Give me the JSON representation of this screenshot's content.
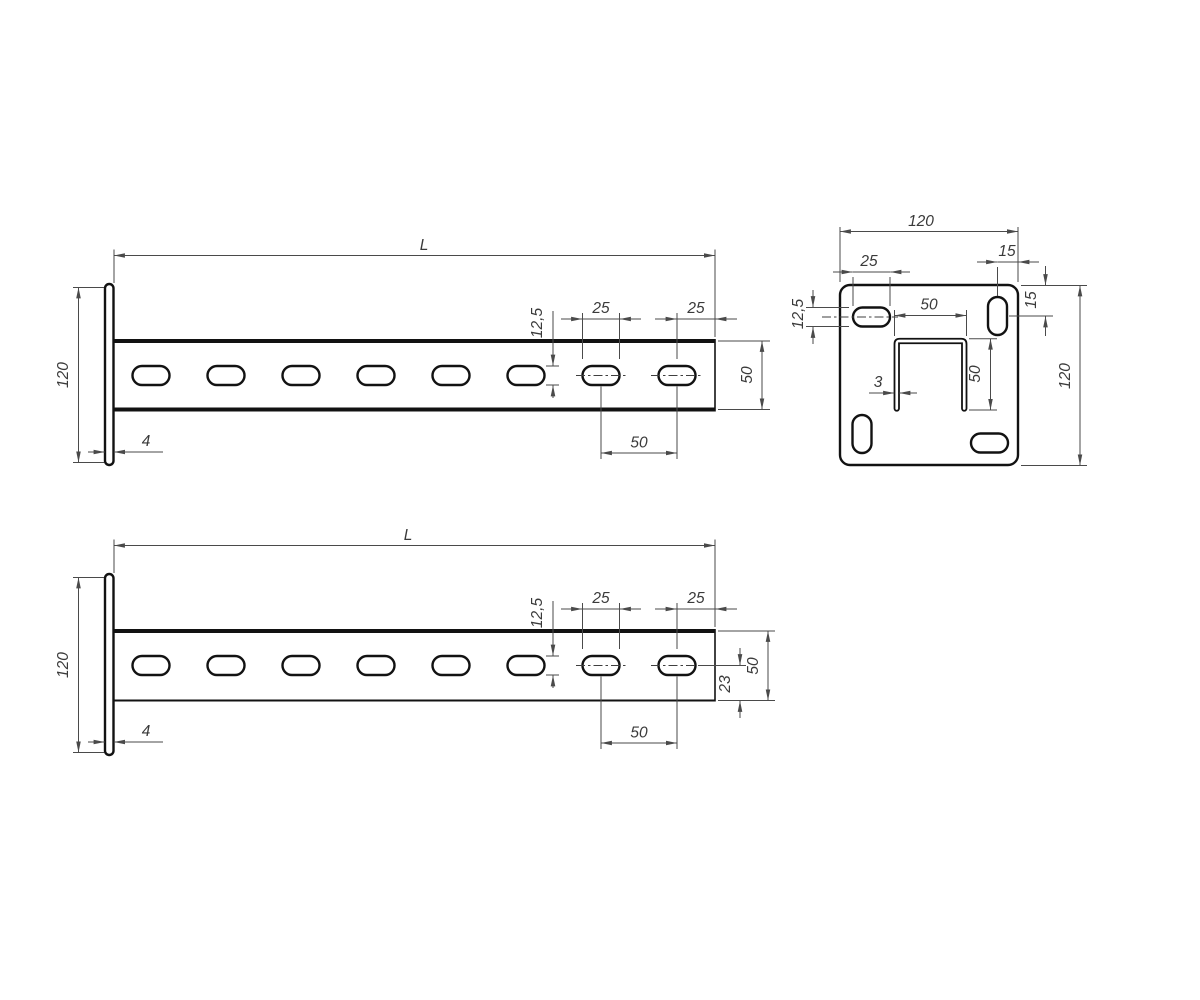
{
  "drawing": {
    "background_color": "#ffffff",
    "object_line_color": "#121212",
    "dimension_line_color": "#4a4a4a",
    "views": {
      "side_a": {
        "length": "L",
        "flange_height": "120",
        "flange_thickness": "4",
        "slot_height": "12,5",
        "slot_length": "25",
        "end_distance": "25",
        "profile_height": "50",
        "slot_pitch": "50"
      },
      "back_plate": {
        "width": "120",
        "height": "120",
        "slot_length": "25",
        "slot_height": "12,5",
        "corner_slot_edge_offset": "15",
        "corner_slot_top_offset": "15",
        "channel_width": "50",
        "channel_depth": "50",
        "channel_wall_thickness": "3"
      },
      "side_b": {
        "length": "L",
        "flange_height": "120",
        "flange_thickness": "4",
        "slot_height": "12,5",
        "slot_length": "25",
        "end_distance": "25",
        "profile_height": "50",
        "slot_center_to_bottom": "23",
        "slot_pitch": "50"
      }
    }
  }
}
